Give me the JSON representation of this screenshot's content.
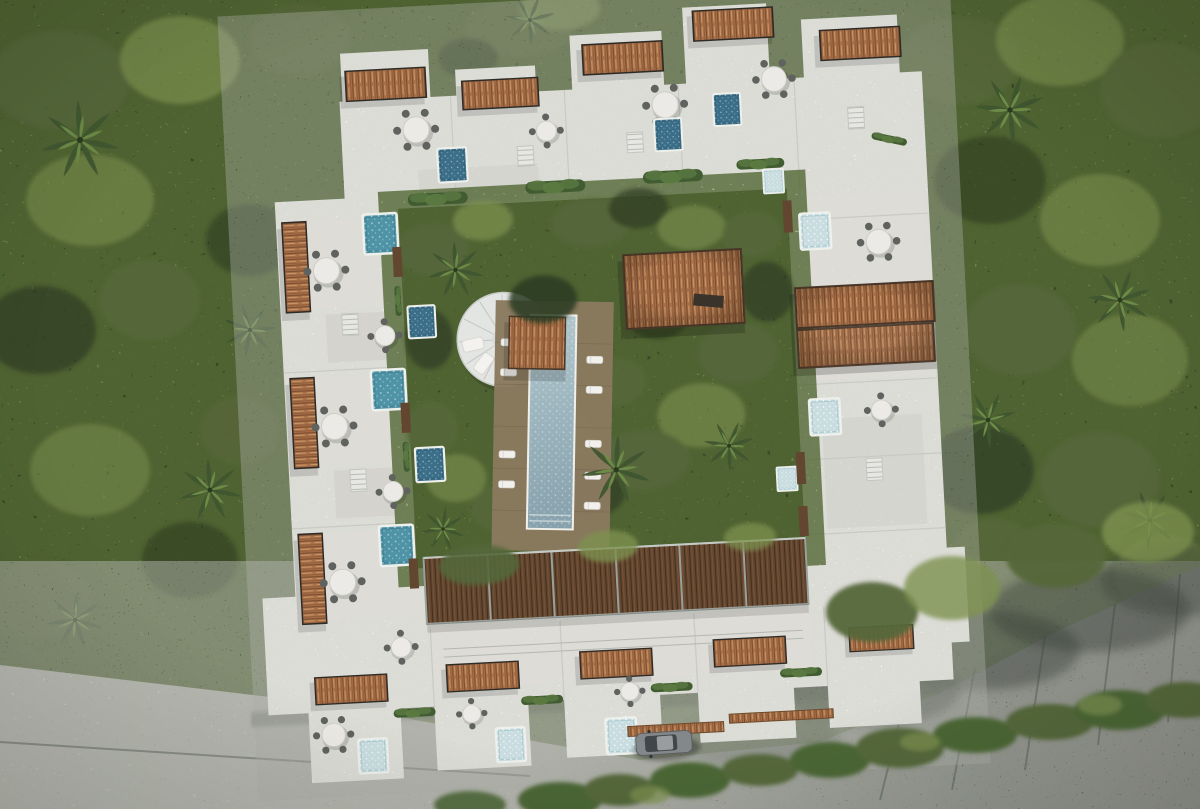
{
  "meta": {
    "kind": "aerial-architectural-render",
    "width": 1200,
    "height": 809
  },
  "scene": {
    "description": "Top-down aerial render of a white square apartment complex surrounded by dense jungle canopy. Rooftop terraces have thatched pergolas, teal and navy plunge pools, round dining tables and planters. The inner courtyard holds a long lap pool with wooden deck and sun loungers, a circular lounge deck, a thatched palapa roof and garden trees behind a dark wood slat screen. A concrete street runs along the bottom edge with a parked car and roadside bushes.",
    "environment": {
      "label": "jungle-canopy",
      "features": [
        "dense tropical trees",
        "palm trees"
      ]
    },
    "road": {
      "label": "street",
      "surface": "concrete with expansion joints and tree shadows",
      "vehicles": [
        {
          "label": "parked-car",
          "color_key": "car_body"
        }
      ],
      "roadside": "bush row along lower right edge"
    },
    "building": {
      "label": "apartment-complex",
      "shape": "square ring around courtyard",
      "wings": [
        "west",
        "north",
        "east",
        "south"
      ],
      "rooftop_features": {
        "thatch_pergolas": 13,
        "plunge_pools": {
          "teal": 3,
          "navy": 5,
          "pale": 7
        },
        "dining_tables": 12,
        "planter_hedges": 11,
        "stairwells": 6,
        "wood_privacy_screens": 6
      },
      "courtyard": {
        "features": [
          "lap-pool",
          "pool-head-pergola",
          "circular-lounge-deck",
          "palapa-roof",
          "wood-slat-screen",
          "garden-trees",
          "sun-loungers",
          "ground-floor-pools"
        ]
      }
    }
  },
  "palette": {
    "canopy_base": "#46552f",
    "canopy_dark": "#2c3a22",
    "canopy_mid": "#55673a",
    "canopy_light": "#7d9150",
    "canopy_glint": "#a3b86b",
    "palm_dark": "#3f5630",
    "palm_light": "#6d8a48",
    "veg_bush": "#4c6636",
    "road_light": "#c6c6c0",
    "road_mid": "#9b9e97",
    "road_dark": "#6b716b",
    "road_shadow": "#39413a",
    "road_joint": "#7e837d",
    "building_white": "#f5f4f0",
    "terrace_light": "#dddcd7",
    "terrace_mid": "#cbcac5",
    "parapet_line": "#c7c8c3",
    "frame_gray": "#9aa09b",
    "thatch_base": "#a9714a",
    "thatch_dark": "#7c4e2f",
    "thatch_light": "#c99767",
    "wood_slat": "#63462f",
    "wood_slat_dark": "#43301f",
    "wood_slat_light": "#7a573a",
    "deck_wood": "#8a7a5f",
    "deck_wood_dark": "#6f6049",
    "bench_dark": "#3a332c",
    "pool_teal": "#4e93a6",
    "pool_navy": "#3b6e88",
    "pool_pale": "#c9dde0",
    "lap_pool_light": "#a9c0c6",
    "lap_pool_deep": "#86a0ac",
    "table_white": "#eceae6",
    "chair_dark": "#5f625e",
    "car_body": "#85888a",
    "car_glass": "#41464a",
    "car_trim": "#2f3336"
  }
}
